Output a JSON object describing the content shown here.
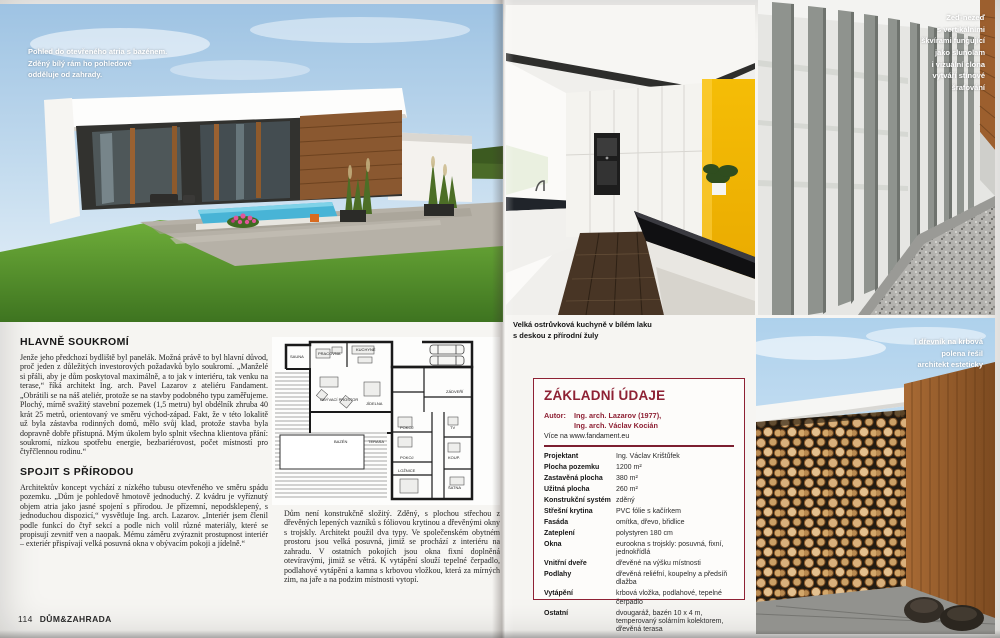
{
  "magazine": {
    "page_number": "114",
    "brand": "DŮM&ZAHRADA"
  },
  "left_page": {
    "photo_caption": "Pohled do otevřeného atria s bazénem.\nZděný bílý rám ho pohledově\nodděluje od zahrady.",
    "article": {
      "section1_title": "HLAVNĚ SOUKROMÍ",
      "section1_body": "Jenže jeho předchozí bydliště byl panelák. Možná právě to byl hlavní důvod, proč jeden z důležitých investorových požadavků bylo soukromí. „Manželé si přáli, aby je dům poskytoval maximálně, a to jak v interiéru, tak venku na terase,“ říká architekt Ing. arch. Pavel Lazarov z ateliéru Fandament. „Obrátili se na náš ateliér, protože se na stavby podobného typu zaměřujeme. Plochý, mírně svažitý stavební pozemek (1,5 metru) byl obdélník zhruba 40 krát 25 metrů, orientovaný ve směru východ-západ. Fakt, že v této lokalitě už byla zástavba rodinných domů, mělo svůj klad, protože stavba byla dopravně dobře přístupná. Mým úkolem bylo splnit všechna klientova přání: soukromí, nízkou spotřebu energie, bezbariérovost, počet místností pro čtyřčlennou rodinu.“",
      "section2_title": "SPOJIT S PŘÍRODOU",
      "section2_body": "Architektův koncept vychází z nízkého tubusu otevřeného ve směru spádu pozemku. „Dům je pohledově hmotově jednoduchý. Z kvádru je vyříznutý objem atria jako jasné spojení s přírodou. Je přízemní, nepodsklepený, s jednoduchou dispozicí,“ vysvětluje Ing. arch. Lazarov. „Interiér jsem členil podle funkcí do čtyř sekcí a podle nich volil různé materiály, které se propisují zevnitř ven a naopak. Mému záměru zvýraznit prostupnost interiér – exteriér přispívají velká posuvná okna v obývacím pokoji a jídelně.“",
      "continuation": "Dům není konstrukčně složitý. Zděný, s plochou střechou z dřevěných lepených vazníků s fóliovou krytinou a dřevěnými okny s trojskly. Architekt použil dva typy. Ve společenském obytném prostoru jsou velká posuvná, jimiž se prochází z interiéru na zahradu. V ostatních pokojích jsou okna fixní doplněná otevíravými, jimiž se větrá. K vytápění slouží tepelné čerpadlo, podlahové vytápění a kamna s krbovou vložkou, která za mírných zim, na jaře a na podzim místnosti vytopí."
    },
    "floorplan": {
      "rooms": [
        "SAUNA",
        "PRACOVNA",
        "KUCHYNĚ",
        "OBÝVACÍ PROSTOR",
        "JÍDELNA",
        "BAZÉN",
        "TERASA",
        "POKOJ",
        "POKOJ",
        "LOŽNICE",
        "KOUP.",
        "TV",
        "ŠATNA",
        "ZÁDVEŘÍ"
      ]
    }
  },
  "right_page": {
    "kitchen_caption": "Velká ostrůvková kuchyně v bílém laku\ns deskou z přírodní žuly",
    "wall_caption": "Zeď-nezeď\ns vertikálními\nškvírami fungující\njako slunolam\ni vizuální clona\nvytváří stínové\nšrafování",
    "woodstore_caption": "I dřevník na krbová\npolena řešil\narchitekt esteticky",
    "infobox": {
      "title": "ZÁKLADNÍ ÚDAJE",
      "author_label": "Autor:",
      "author_lines": "Ing. arch. Lazarov (1977),\nIng. arch. Václav Kocián",
      "more": "Více na www.fandament.eu",
      "rows": [
        {
          "label": "Projektant",
          "value": "Ing. Václav Krištůfek"
        },
        {
          "label": "Plocha pozemku",
          "value": "1200 m²"
        },
        {
          "label": "Zastavěná plocha",
          "value": "380 m²"
        },
        {
          "label": "Užitná plocha",
          "value": "260 m²"
        },
        {
          "label": "Konstrukční systém",
          "value": "zděný"
        },
        {
          "label": "Střešní krytina",
          "value": "PVC fólie s kačírkem"
        },
        {
          "label": "Fasáda",
          "value": "omítka, dřevo, břidlice"
        },
        {
          "label": "Zateplení",
          "value": "polystyren 180 cm"
        },
        {
          "label": "Okna",
          "value": "eurookna s trojskly: posuvná, fixní, jednokřídlá"
        },
        {
          "label": "Vnitřní dveře",
          "value": "dřevěné na výšku místnosti"
        },
        {
          "label": "Podlahy",
          "value": "dřevěná reliéfní, koupelny a předsíň dlažba"
        },
        {
          "label": "Vytápění",
          "value": "krbová vložka, podlahové, tepelné čerpadlo"
        },
        {
          "label": "Ostatní",
          "value": "dvougaráž, bazén 10 x 4 m, temperovaný solárním kolektorem, dřevěná terasa"
        }
      ]
    }
  },
  "colors": {
    "accent_red": "#8e2134",
    "kitchen_yellow": "#f3b800",
    "sky_blue": "#9ec3e3",
    "lawn_green": "#5f9c33"
  }
}
